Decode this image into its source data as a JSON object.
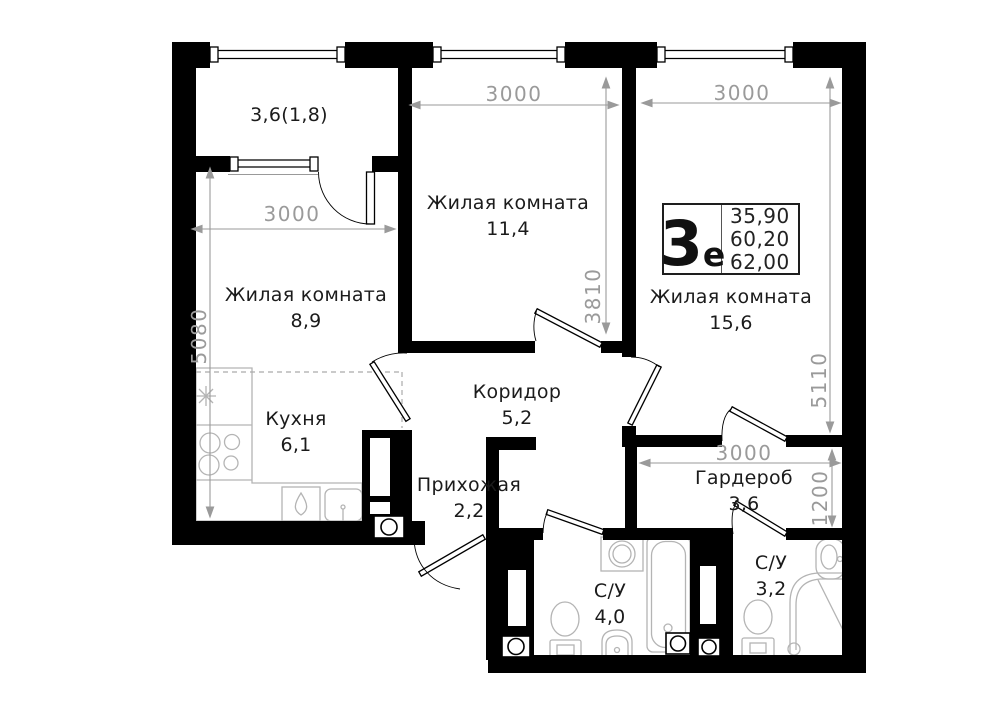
{
  "plan": {
    "logo": {
      "big": "3",
      "small": "е",
      "areas": [
        "35,90",
        "60,20",
        "62,00"
      ]
    },
    "rooms": {
      "balcony": {
        "label": "3,6(1,8)"
      },
      "room11": {
        "name": "Жилая комната",
        "area": "11,4"
      },
      "room15": {
        "name": "Жилая комната",
        "area": "15,6"
      },
      "room8": {
        "name": "Жилая комната",
        "area": "8,9"
      },
      "kitchen": {
        "name": "Кухня",
        "area": "6,1"
      },
      "corridor": {
        "name": "Коридор",
        "area": "5,2"
      },
      "hallway": {
        "name": "Прихожая",
        "area": "2,2"
      },
      "wardrobe": {
        "name": "Гардероб",
        "area": "3,6"
      },
      "bath1": {
        "name": "С/У",
        "area": "4,0"
      },
      "bath2": {
        "name": "С/У",
        "area": "3,2"
      }
    },
    "dimensions": {
      "room8_width": "3000",
      "room8_height": "5080",
      "room11_width": "3000",
      "room11_height": "3810",
      "room15_width": "3000",
      "room15_height": "5110",
      "wardrobe_width": "3000",
      "wardrobe_height": "1200"
    },
    "colors": {
      "wall": "#000000",
      "dimension": "#9a9a9a",
      "fixture": "#b4b4b4"
    }
  }
}
